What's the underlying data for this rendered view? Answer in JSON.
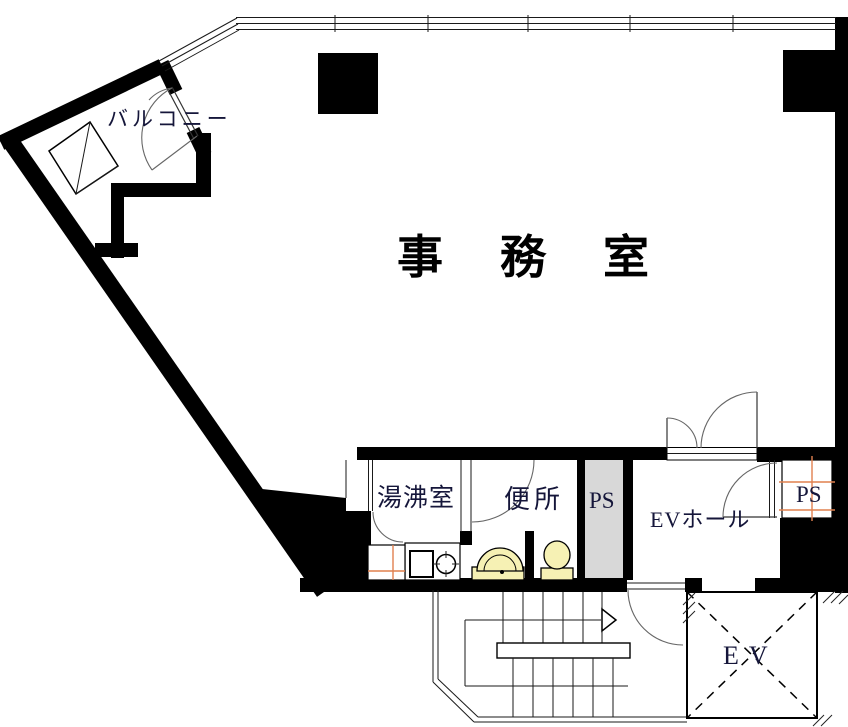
{
  "floor_plan": {
    "rooms": {
      "office": "事務室",
      "balcony": "バルコニー",
      "kitchenette": "湯沸室",
      "toilet": "便所",
      "pipe_space_left": "PS",
      "pipe_space_right": "PS",
      "elevator_hall": "EVホール",
      "elevator": "EV"
    },
    "colors": {
      "wall": "#000000",
      "door_arc": "#666666",
      "fixture_fill": "#f6f1b4",
      "pipe_shaft_fill": "#d8d8d8",
      "hatch_orange": "#e0804f",
      "label_ink": "#15163a"
    }
  }
}
